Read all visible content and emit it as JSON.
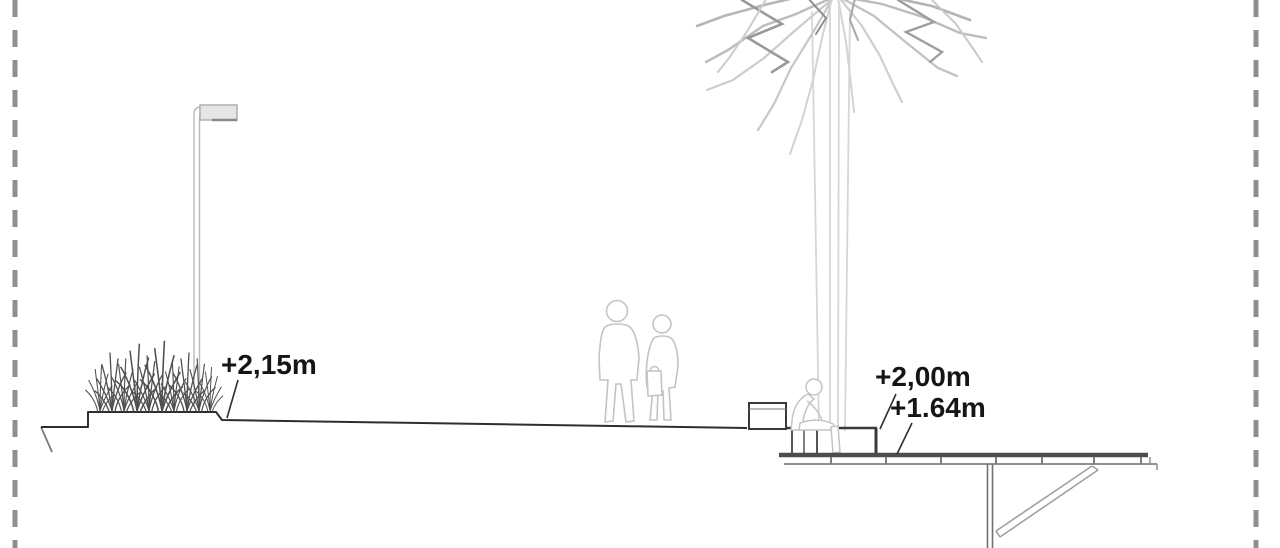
{
  "drawing": {
    "kind": "architectural section drawing of a waterfront promenade and timber deck",
    "labels": {
      "promenade_level": "+2,15m",
      "bench_level": "+2,00m",
      "deck_level": "+1.64m"
    },
    "elements": [
      "lamp-post",
      "ornamental-grass-planter",
      "ground-profile",
      "pedestrian-pair",
      "palm-tree",
      "bench",
      "seated-person",
      "timber-deck",
      "deck-post",
      "diagonal-brace",
      "dashed-frame-borders"
    ],
    "colors": {
      "background": "#ffffff",
      "ink_dark": "#2e2e2e",
      "ink_medium": "#8c8c8c",
      "ink_light": "#c4c4c4",
      "border_dash": "#8f8f8f",
      "deck_line": "#4d4d4d"
    }
  }
}
